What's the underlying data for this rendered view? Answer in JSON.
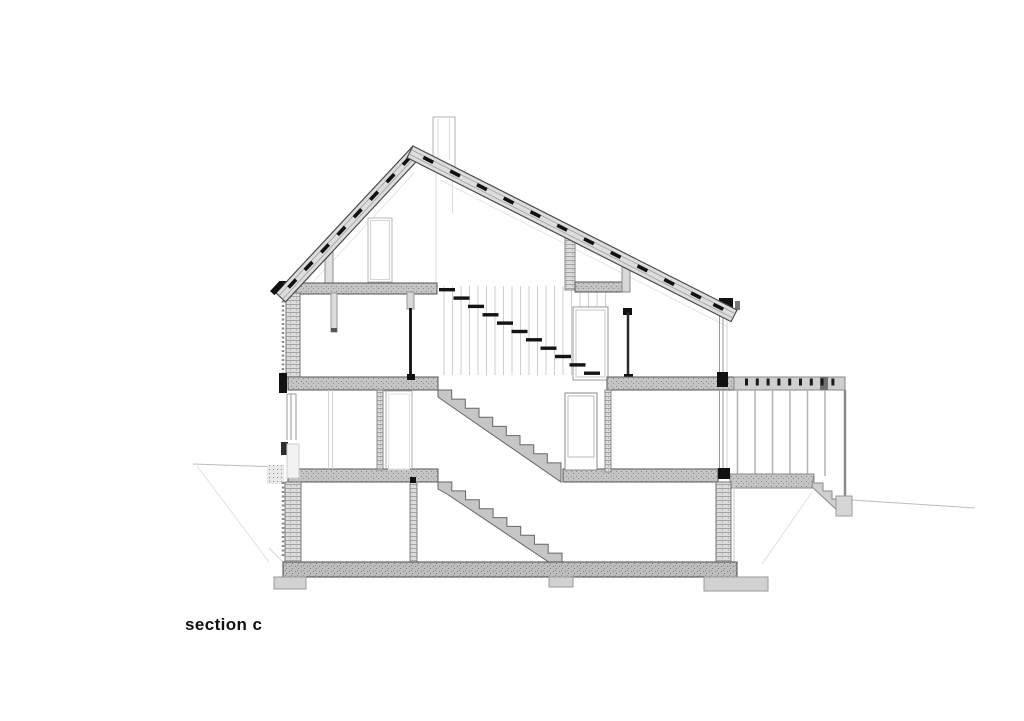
{
  "page": {
    "background_color": "#ffffff"
  },
  "drawing": {
    "label": "section c",
    "kind": "architectural building cross-section",
    "palette": {
      "paper": "#ffffff",
      "ink": "#111111",
      "cut_slab_gray": "#c4c4c4",
      "cut_wall_gray": "#dcdcdc",
      "roof_gray": "#dddddd",
      "foundation_gray": "#bdbdbd",
      "faint_line": "#d8d8d8"
    }
  }
}
